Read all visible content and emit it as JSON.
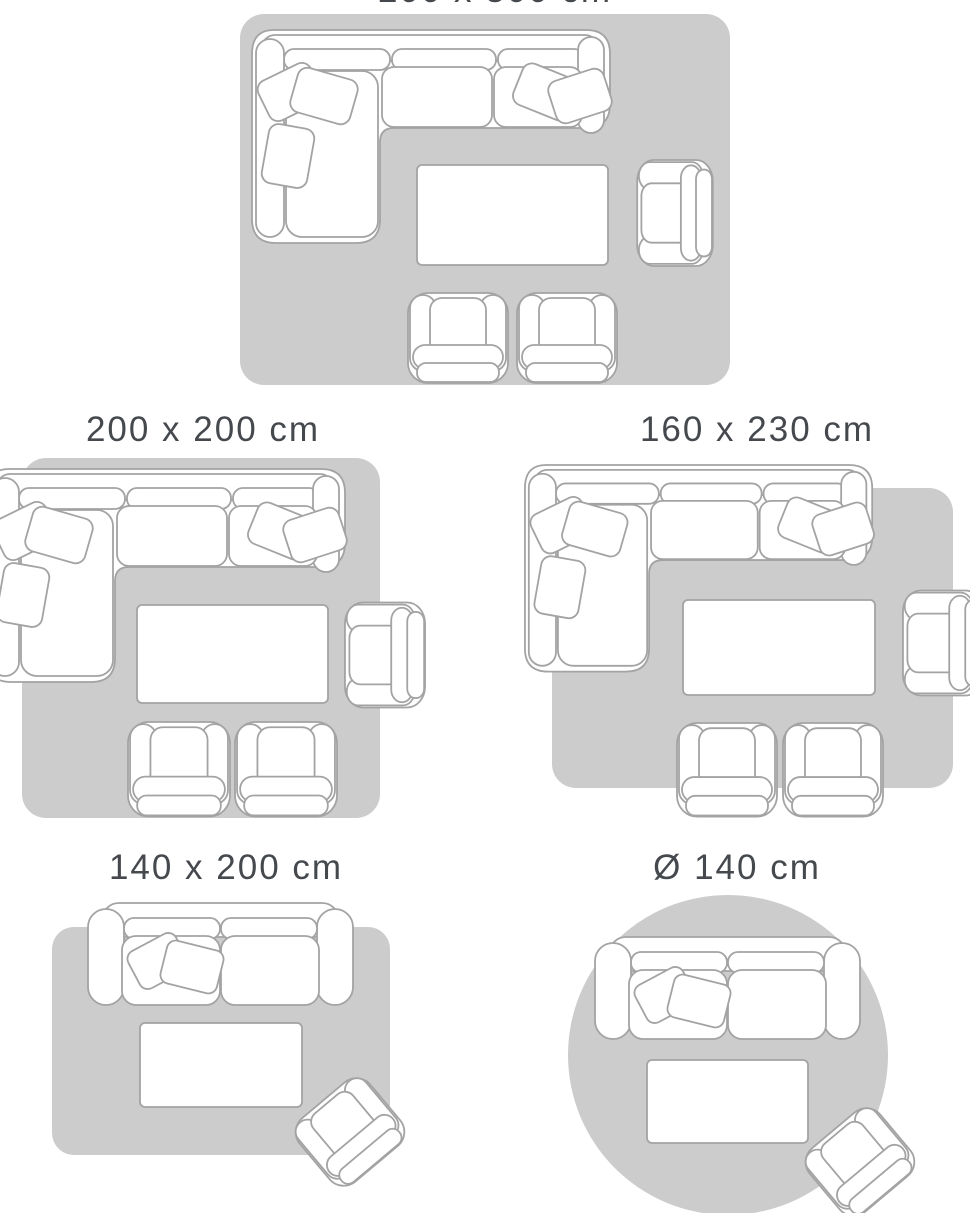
{
  "guide": {
    "type": "rug-size-guide",
    "colors": {
      "background": "#ffffff",
      "rug_fill": "#cccccc",
      "furniture_fill": "#ffffff",
      "furniture_outline": "#a3a3a3",
      "label_text": "#45494e"
    },
    "panels": [
      {
        "label": "200 x 300 cm",
        "label_note": "partially cut off at top edge of image",
        "rug_shape": "rectangle",
        "furniture": [
          "sectional-sofa-with-pillows",
          "coffee-table",
          "armchair-facing-left",
          "armchair-facing-up",
          "armchair-facing-up"
        ]
      },
      {
        "label": "200 x 200 cm",
        "rug_shape": "square",
        "furniture": [
          "sectional-sofa-with-pillows",
          "coffee-table",
          "armchair-facing-left",
          "armchair-facing-up",
          "armchair-facing-up"
        ]
      },
      {
        "label": "160 x 230 cm",
        "rug_shape": "rectangle",
        "furniture": [
          "sectional-sofa-with-pillows",
          "coffee-table",
          "armchair-facing-left",
          "armchair-facing-up",
          "armchair-facing-up"
        ]
      },
      {
        "label": "140 x 200 cm",
        "rug_shape": "rectangle",
        "furniture": [
          "two-seater-sofa-with-pillows",
          "coffee-table",
          "tilted-armchair"
        ]
      },
      {
        "label": "Ø 140 cm",
        "rug_shape": "circle",
        "furniture": [
          "two-seater-sofa-with-pillows",
          "coffee-table",
          "tilted-armchair"
        ]
      }
    ]
  }
}
